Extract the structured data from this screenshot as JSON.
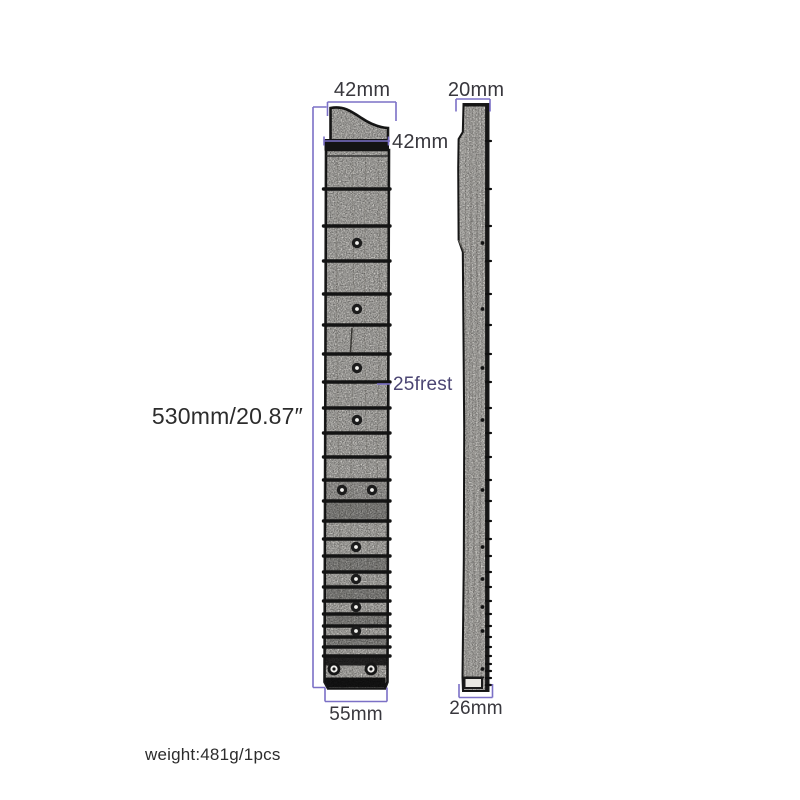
{
  "labels": {
    "top_width": "42mm",
    "nut_width": "42mm",
    "side_thickness": "20mm",
    "length": "530mm/20.87″",
    "fret_count": "25frest",
    "heel_width": "55mm",
    "side_heel_width": "26mm",
    "weight": "weight:481g/1pcs"
  },
  "colors": {
    "dimension_line": "#7b70c6",
    "label_text": "#38373d",
    "length_text": "#2c2c2c",
    "fret_label_text": "#4b4573",
    "outline": "#1a1a1a",
    "wood_fill": "#e9e7e2",
    "fret_metal": "#141414"
  }
}
